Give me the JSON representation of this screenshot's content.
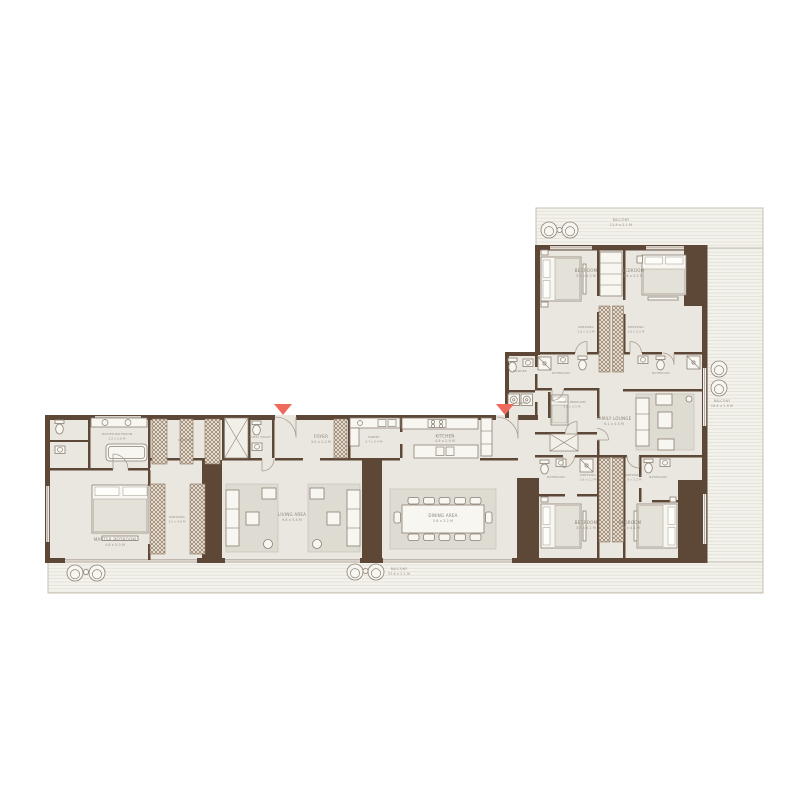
{
  "meta": {
    "type": "residential-floor-plan",
    "shape": "L-shaped",
    "entries": 2
  },
  "colors": {
    "wall": "#5d4837",
    "floor": "#eae7e0",
    "balcony_floor": "#f4f2ec",
    "balcony_line": "#dfdbd0",
    "accent": "#ee6a5c",
    "label_text": "#8b8275"
  },
  "rooms": {
    "balcony_top": {
      "label": "BALCONY",
      "dims": "11.9 x 2.1 M"
    },
    "balcony_right": {
      "label": "BALCONY",
      "dims": "16.4 x 1.9 M"
    },
    "balcony_bottom": {
      "label": "BALCONY",
      "dims": "37.6 x 2.1 M"
    },
    "bedroom_a": {
      "label": "BEDROOM",
      "dims": "3.5 x 4.2 M"
    },
    "bedroom_b": {
      "label": "BEDROOM",
      "dims": "3.6 x 4.2 M"
    },
    "bedroom_c": {
      "label": "BEDROOM",
      "dims": "3.5 x 4.1 M"
    },
    "bedroom_d": {
      "label": "BEDROOM",
      "dims": "3.6 x 4.1 M"
    },
    "dressing_a": {
      "label": "DRESSING",
      "dims": "1.6 x 2.2 M"
    },
    "dressing_b": {
      "label": "DRESSING",
      "dims": "1.6 x 2.2 M"
    },
    "dressing_c": {
      "label": "DRESSING",
      "dims": "1.6 x 2.2 M"
    },
    "dressing_d": {
      "label": "DRESSING",
      "dims": "1.6 x 2.2 M"
    },
    "bathroom_a": {
      "label": "BATHROOM",
      "dims": "2.5 x 1.6 M"
    },
    "bathroom_b": {
      "label": "BATHROOM",
      "dims": "2.5 x 1.6 M"
    },
    "bathroom_c": {
      "label": "BATHROOM",
      "dims": "2.5 x 1.6 M"
    },
    "bathroom_d": {
      "label": "BATHROOM",
      "dims": "2.5 x 1.6 M"
    },
    "powder": {
      "label": "POWDER",
      "dims": "1.6 x 1.9 M"
    },
    "laundry": {
      "label": "LAUNDRY",
      "dims": "1.8 x 1.6 M"
    },
    "maids_bedroom": {
      "label": "MAID'S BEDROOM",
      "dims": "2.9 x 2.5 M"
    },
    "family_lounge": {
      "label": "FAMILY LOUNGE",
      "dims": "6.1 x 4.4 M"
    },
    "master_bathroom": {
      "label": "MASTER BATHROOM",
      "dims": "3.2 x 2.6 M"
    },
    "guest_toilet": {
      "label": "GUEST TOILET",
      "dims": ""
    },
    "dressing_walkin": {
      "label": "DRESSING",
      "dims": ""
    },
    "dressing_master": {
      "label": "DRESSING",
      "dims": "3.5 x 4.6 M"
    },
    "foyer": {
      "label": "FOYER",
      "dims": "3.0 x 2.4 M"
    },
    "pantry": {
      "label": "PANTRY",
      "dims": "2.7 x 2.4 M"
    },
    "kitchen": {
      "label": "KITCHEN",
      "dims": "4.9 x 2.9 M"
    },
    "living_area": {
      "label": "LIVING AREA",
      "dims": "9.8 x 5.4 M"
    },
    "dining_area": {
      "label": "DINING AREA",
      "dims": "5.8 x 3.2 M"
    },
    "master_bedroom": {
      "label": "MASTER BEDROOM",
      "dims": "4.8 x 5.0 M"
    }
  }
}
